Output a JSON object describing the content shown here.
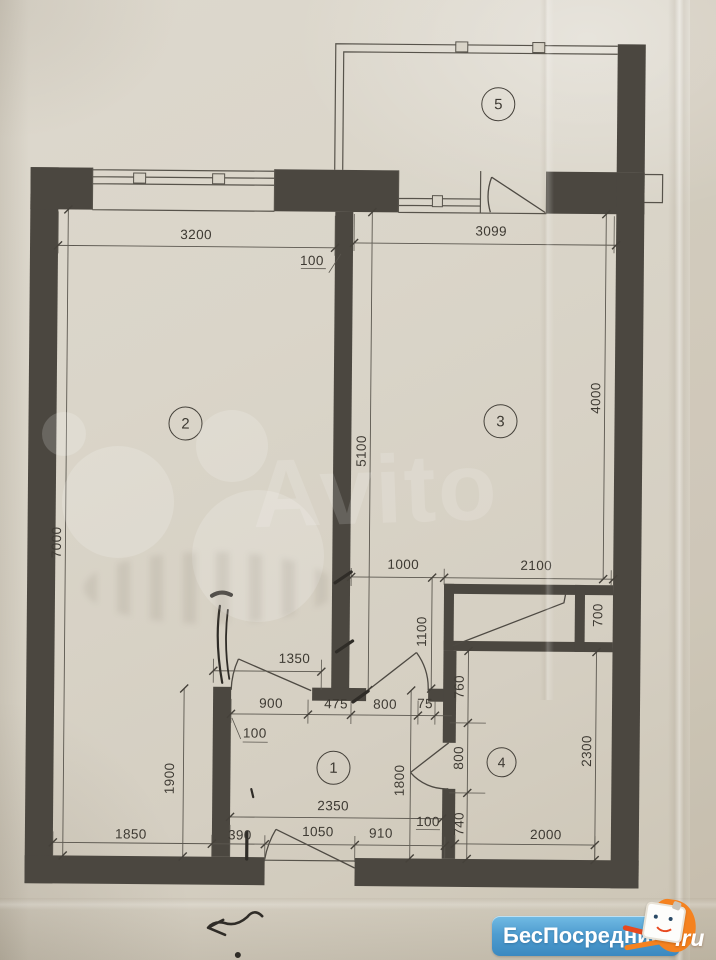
{
  "plan": {
    "rooms": [
      {
        "number": "1"
      },
      {
        "number": "2"
      },
      {
        "number": "3"
      },
      {
        "number": "4"
      },
      {
        "number": "5"
      }
    ],
    "dims": {
      "top_room2_width": "3200",
      "top_room3_width": "3099",
      "wall_thickness_top": "100",
      "room3_height": "5100",
      "room3_right_height": "4000",
      "left_total_height": "7000",
      "closet_offset": "1000",
      "closet_width": "2100",
      "closet_depth": "1100",
      "closet_small_width": "700",
      "room2_door_opening": "1350",
      "hall_top_seg1": "900",
      "hall_top_seg2": "475",
      "hall_top_seg3": "800",
      "hall_top_seg4": "75",
      "hall_wall_thickness": "100",
      "room4_left_seg1": "760",
      "room4_left_seg2": "800",
      "room4_left_seg3": "740",
      "room4_right_height": "2300",
      "room2_lower_height": "1900",
      "hall_height": "1800",
      "hall_width": "2350",
      "bottom_seg1": "1850",
      "bottom_seg2": "390",
      "bottom_seg3": "1050",
      "bottom_seg4": "910",
      "bottom_wall_thickness": "100",
      "room4_width": "2000"
    }
  },
  "watermark": {
    "text": "Avito"
  },
  "logo": {
    "brand": "БесПосредника",
    "tld": ".ru"
  }
}
